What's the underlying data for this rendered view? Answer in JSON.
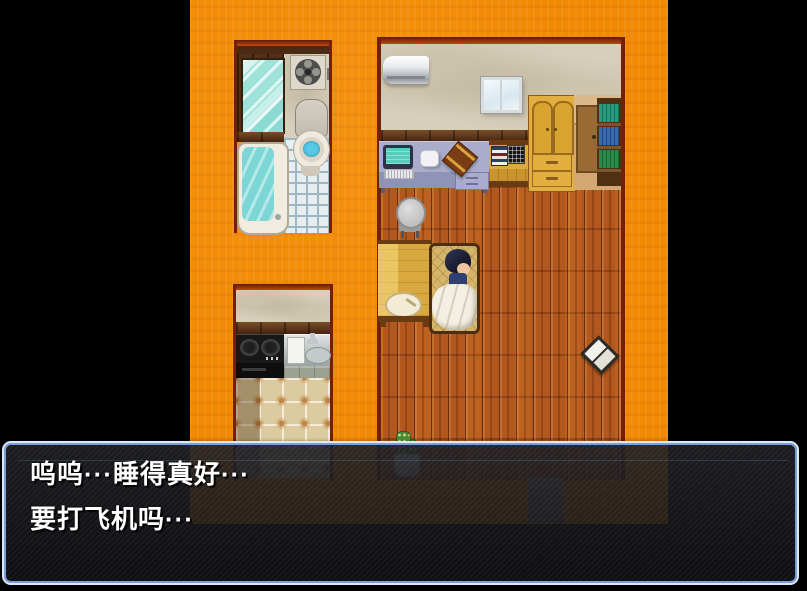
{
  "dialogue": {
    "lines": [
      "呜呜···睡得真好···",
      "要打飞机吗···"
    ]
  },
  "colors": {
    "letterbox": "#000000",
    "wall_orange": "#f28a06",
    "room_wall_beige": "#d8cfbb",
    "wood_floor": "#b2581e",
    "trim_brown": "#5c3114",
    "water_teal": "#7cd6d6",
    "toilet_water_blue": "#58c8e4",
    "dialog_border_outer": "#dfe9f6",
    "dialog_border_inner": "#7aa0dc",
    "dialog_background": "rgba(22,22,26,0.87)",
    "dialog_text": "#ffffff"
  },
  "objects": [
    "bathroom-mirror",
    "ventilation-fan",
    "toilet",
    "bathtub",
    "kitchen-stove",
    "kitchen-sink",
    "air-conditioner",
    "window",
    "computer-desk",
    "computer-monitor",
    "side-table",
    "wardrobe",
    "cabinet",
    "bookshelf",
    "office-chair",
    "long-table",
    "plate",
    "bed",
    "sleeping-character",
    "white-blanket",
    "open-book",
    "potted-cactus",
    "door-mat"
  ]
}
